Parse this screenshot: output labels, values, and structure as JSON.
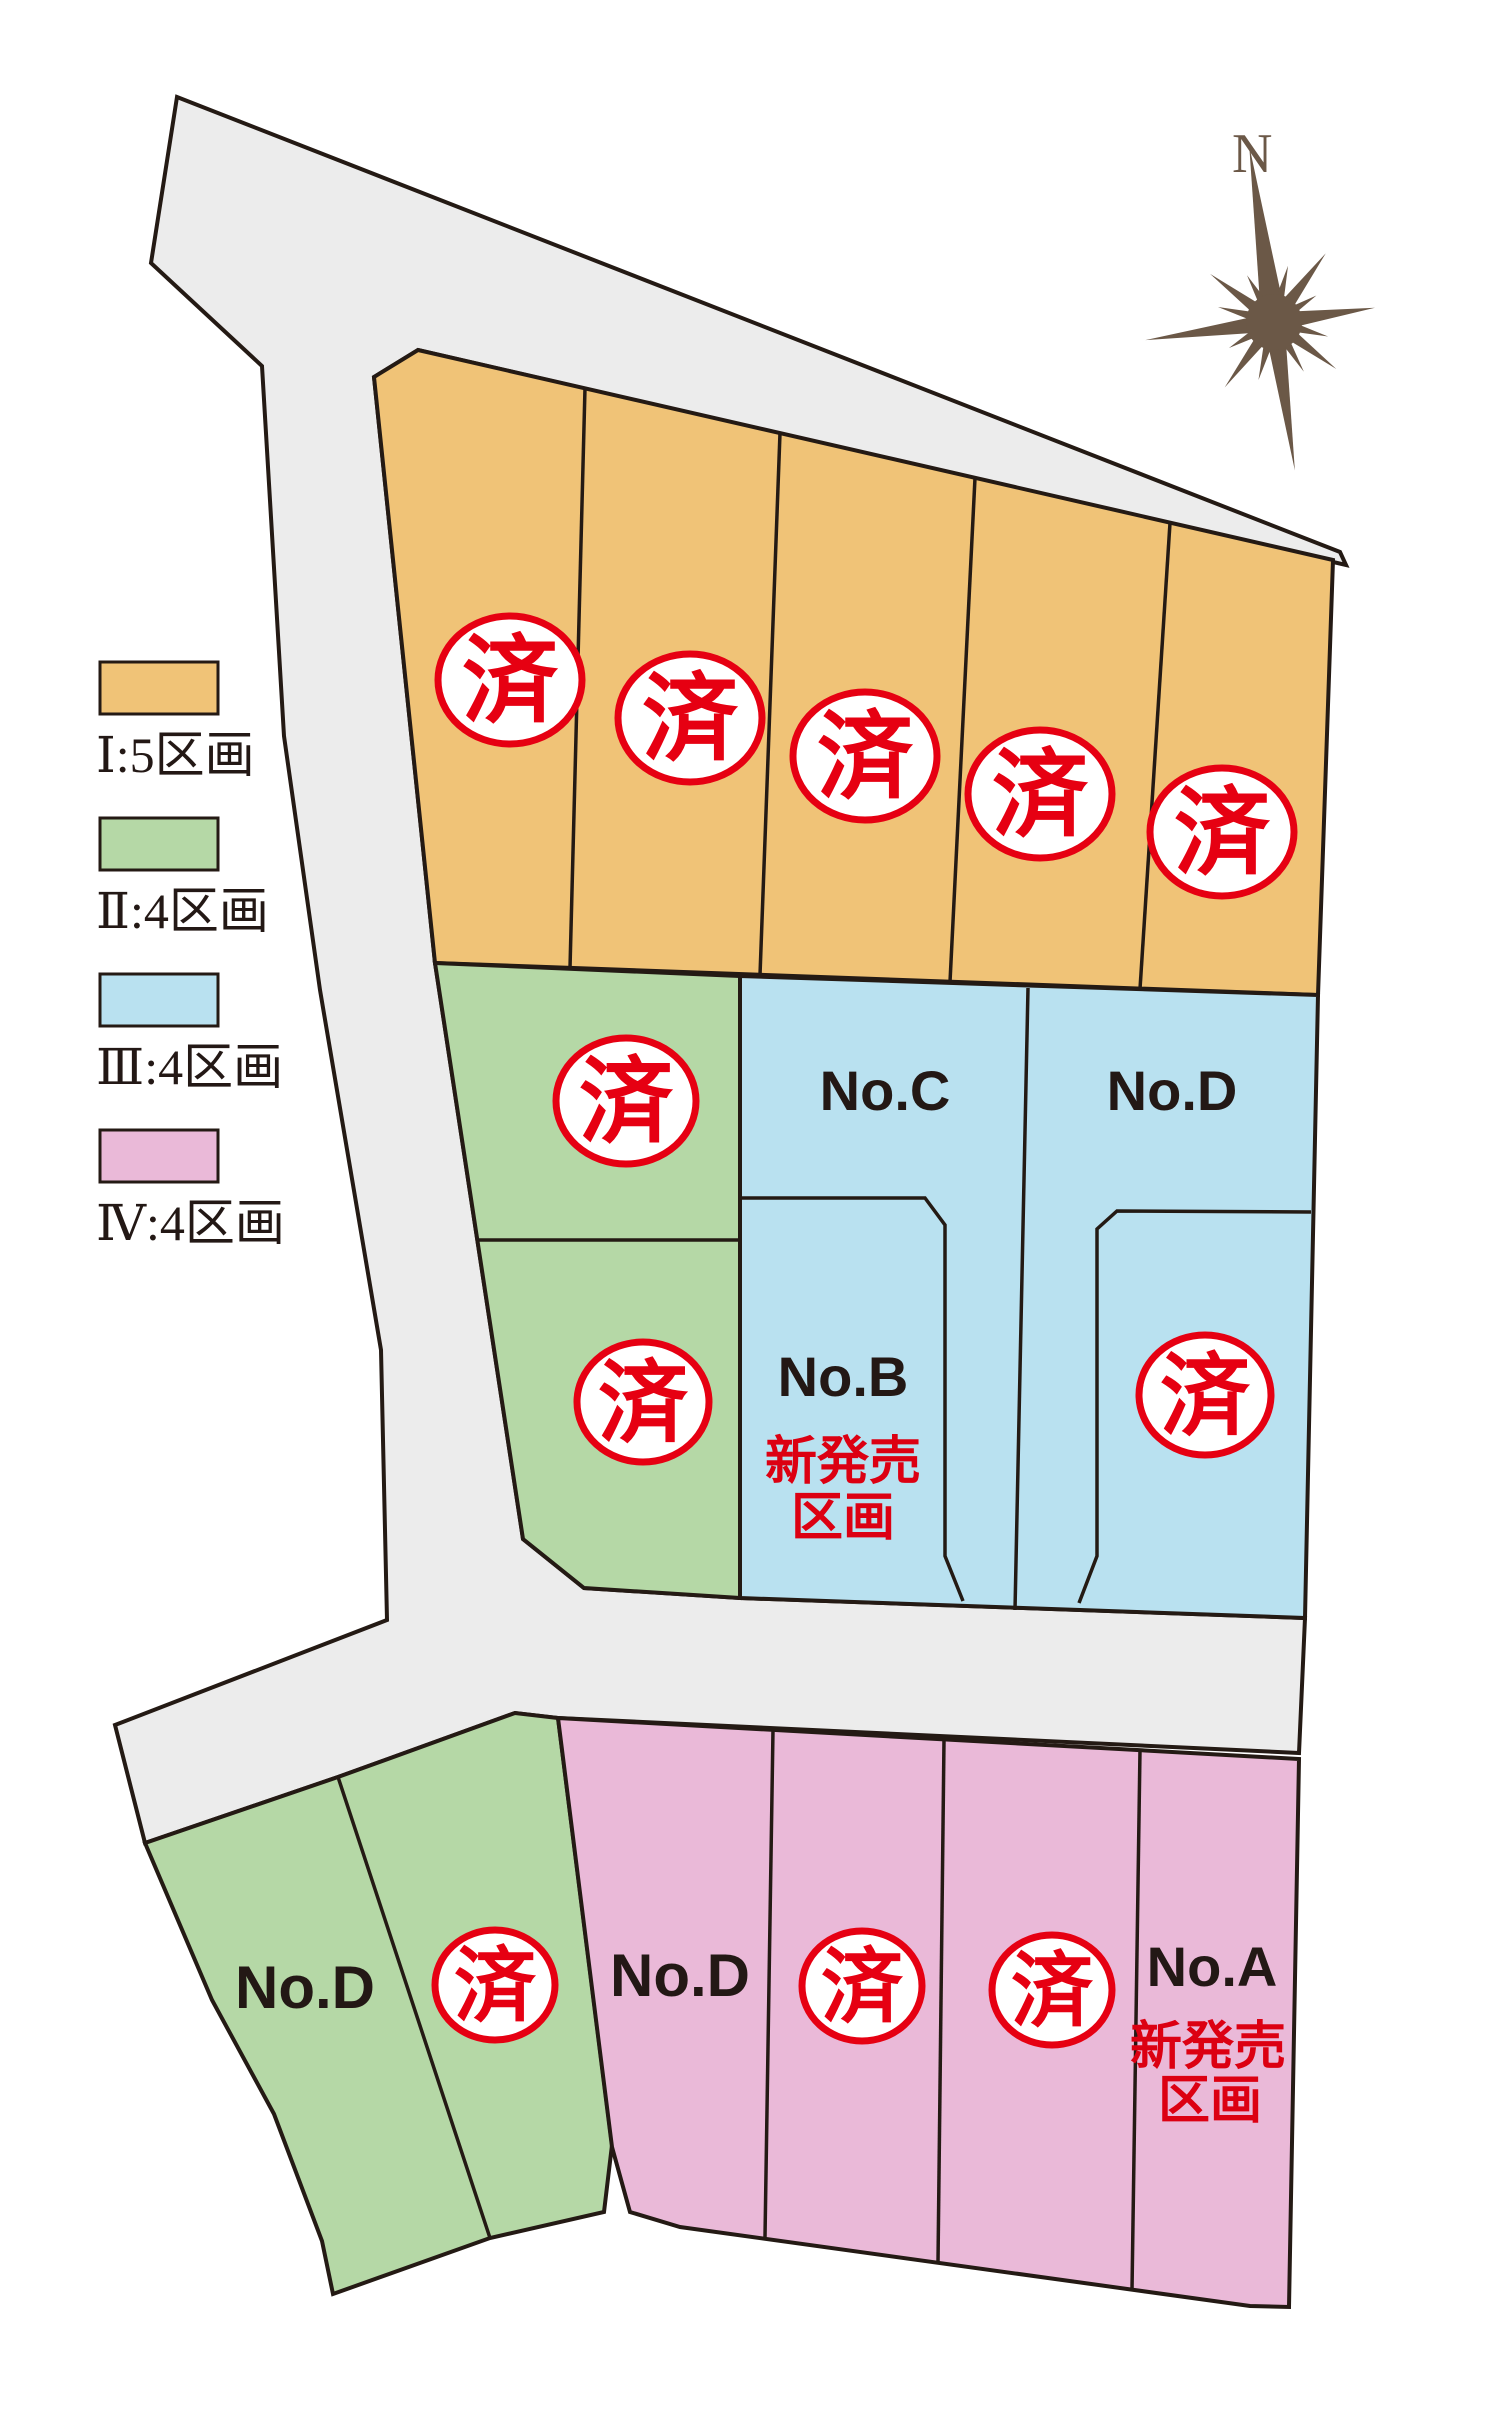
{
  "compass": {
    "north_label": "N"
  },
  "legend": {
    "items": [
      {
        "label": "Ⅰ:5区画",
        "color": "#f0c377"
      },
      {
        "label": "Ⅱ:4区画",
        "color": "#b5d8a6"
      },
      {
        "label": "Ⅲ:4区画",
        "color": "#b9e1f0"
      },
      {
        "label": "Ⅳ:4区画",
        "color": "#eab9d8"
      }
    ]
  },
  "map": {
    "road_color": "#ececec",
    "outline_color": "#241a14",
    "label_color": "#231815",
    "sold_mark": "済",
    "sold_color": "#e60012",
    "new_release_color": "#dc0012",
    "new_release_line1": "新発売",
    "new_release_line2": "区画",
    "compass_color": "#6b5847",
    "sections": [
      {
        "id": "phase1",
        "color": "#f0c377",
        "plots": [
          {
            "status": "sold"
          },
          {
            "status": "sold"
          },
          {
            "status": "sold"
          },
          {
            "status": "sold"
          },
          {
            "status": "sold"
          }
        ]
      },
      {
        "id": "phase2-upper",
        "color": "#b5d8a6",
        "plots": [
          {
            "status": "sold"
          },
          {
            "status": "sold"
          }
        ]
      },
      {
        "id": "phase3",
        "color": "#b9e1f0",
        "plots": [
          {
            "label": "No.C"
          },
          {
            "label": "No.D"
          },
          {
            "label": "No.B",
            "new_release": true
          },
          {
            "status": "sold"
          }
        ]
      },
      {
        "id": "phase2-lower",
        "color": "#b5d8a6",
        "plots": [
          {
            "label": "No.D"
          },
          {
            "status": "sold"
          }
        ]
      },
      {
        "id": "phase4",
        "color": "#eab9d8",
        "plots": [
          {
            "label": "No.D"
          },
          {
            "status": "sold"
          },
          {
            "status": "sold"
          },
          {
            "label": "No.A",
            "new_release": true
          }
        ]
      }
    ]
  }
}
